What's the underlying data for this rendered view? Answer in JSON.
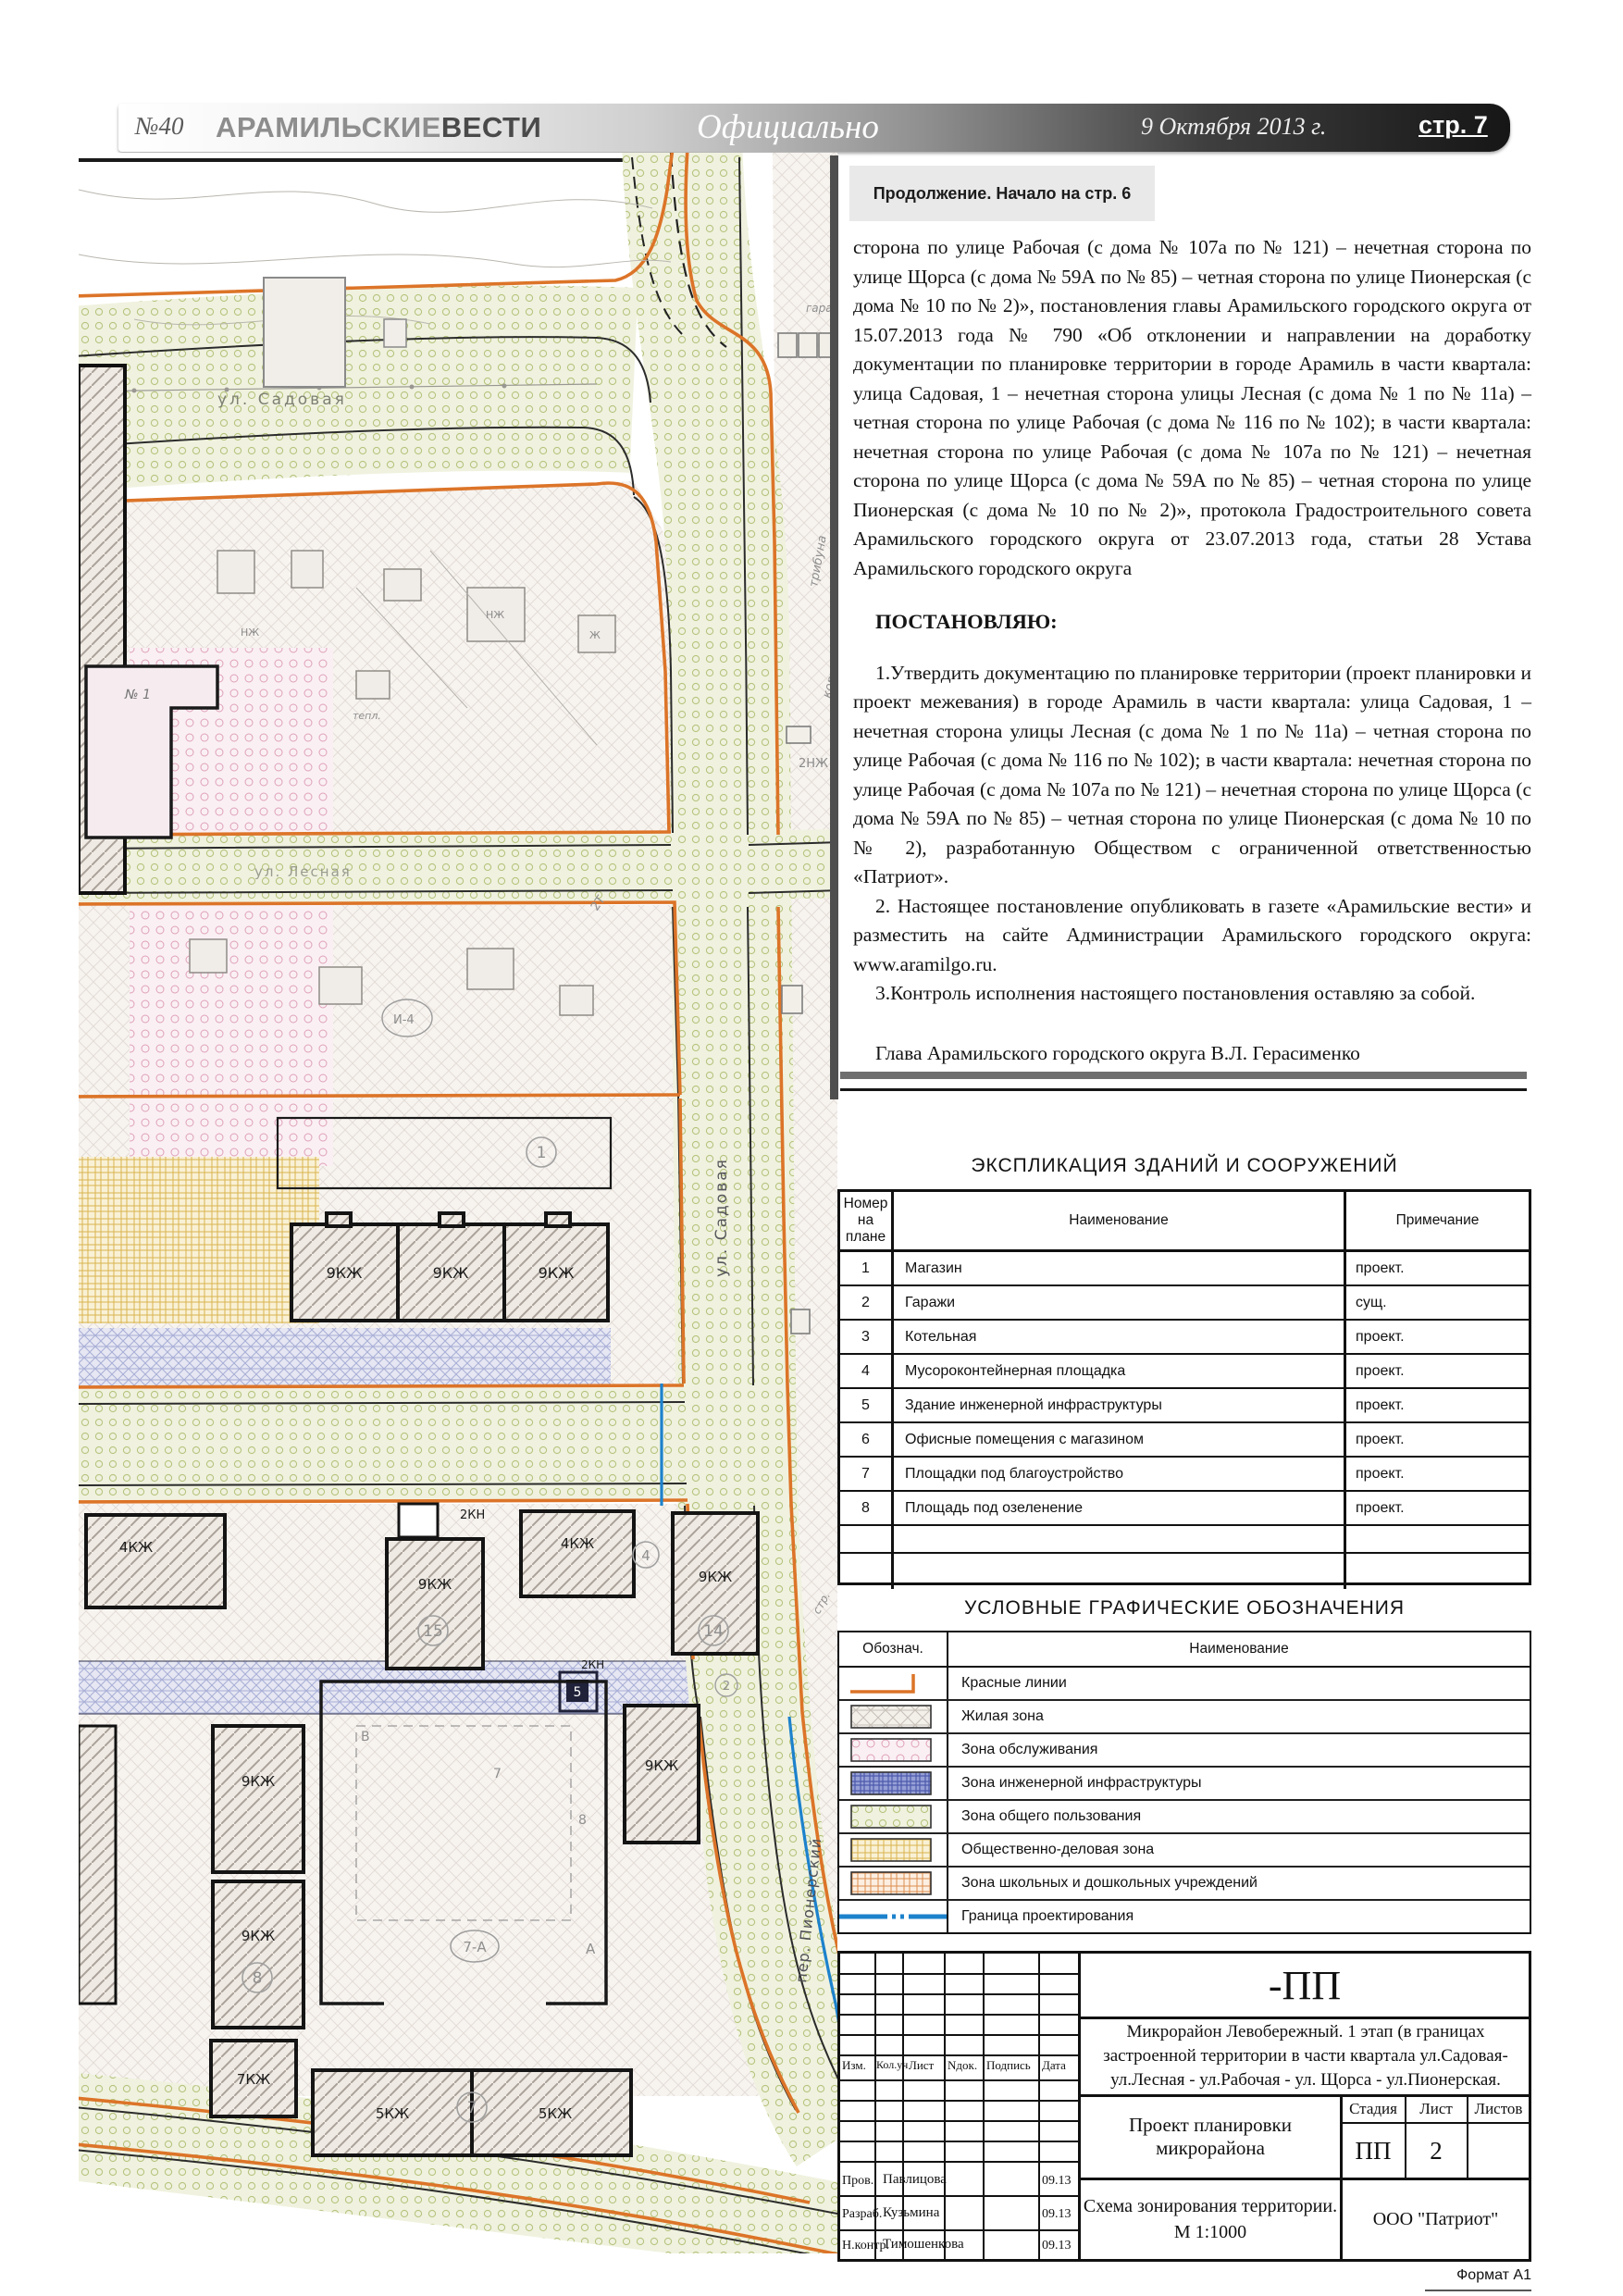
{
  "header": {
    "issue": "№40",
    "brand_light": "АРАМИЛЬСКИЕ",
    "brand_bold": "ВЕСТИ",
    "section": "Официально",
    "date": "9 Октября 2013 г.",
    "page": "стр. 7"
  },
  "continuation_notice": "Продолжение. Начало на стр. 6",
  "article": {
    "paragraphs": [
      "сторона по улице Рабочая (с дома № 107а по № 121) – нечетная сторона по улице Щорса (с дома № 59А по № 85) – четная сторона по улице Пионерская (с дома № 10 по № 2)», постановления главы Арамильского городского округа от 15.07.2013 года № 790 «Об отклонении и направлении на доработку документации по планировке территории в городе Арамиль в части квартала: улица Садовая, 1 – нечетная сторона улицы Лесная (с дома № 1 по № 11а) – четная сторона по улице Рабочая (с дома № 116 по № 102); в части квартала: нечетная сторона по улице Рабочая (с дома № 107а по № 121) – нечетная сторона по улице Щорса (с дома № 59А по № 85) – четная сторона по улице Пионерская (с дома № 10 по № 2)», протокола Градостроительного совета Арамильского городского округа от 23.07.2013 года, статьи 28 Устава Арамильского городского округа"
    ],
    "resolve_heading": "ПОСТАНОВЛЯЮ:",
    "items": [
      "1.Утвердить документацию по планировке территории (проект планировки и проект межевания) в городе Арамиль в части квартала: улица Садовая, 1 – нечетная сторона улицы Лесная (с дома № 1 по № 11а) – четная сторона по улице Рабочая (с дома № 116 по № 102); в части квартала: нечетная сторона по улице Рабочая (с дома № 107а по № 121) – нечетная сторона по улице Щорса (с дома № 59А по № 85) – четная сторона по улице Пионерская (с дома № 10 по № 2), разработанную Обществом с ограниченной ответственностью «Патриот».",
      "2. Настоящее постановление опубликовать в газете «Арамильские вести» и разместить на сайте Администрации Арамильского городского округа: www.aramilgo.ru.",
      "3.Контроль исполнения настоящего постановления оставляю за собой."
    ],
    "signature": "Глава Арамильского городского округа В.Л. Герасименко"
  },
  "explication": {
    "title": "ЭКСПЛИКАЦИЯ ЗДАНИЙ И СООРУЖЕНИЙ",
    "columns": [
      "Номер на плане",
      "Наименование",
      "Примечание"
    ],
    "rows": [
      [
        "1",
        "Магазин",
        "проект."
      ],
      [
        "2",
        "Гаражи",
        "сущ."
      ],
      [
        "3",
        "Котельная",
        "проект."
      ],
      [
        "4",
        "Мусороконтейнерная площадка",
        "проект."
      ],
      [
        "5",
        "Здание инженерной инфраструктуры",
        "проект."
      ],
      [
        "6",
        "Офисные помещения с магазином",
        "проект."
      ],
      [
        "7",
        "Площадки под благоустройство",
        "проект."
      ],
      [
        "8",
        "Площадь под озеленение",
        "проект."
      ]
    ]
  },
  "legend": {
    "title": "УСЛОВНЫЕ ГРАФИЧЕСКИЕ ОБОЗНАЧЕНИЯ",
    "columns": [
      "Обознач.",
      "Наименование"
    ],
    "rows": [
      {
        "symbol": "red-lines",
        "label": "Красные линии"
      },
      {
        "symbol": "residential",
        "label": "Жилая зона"
      },
      {
        "symbol": "service",
        "label": "Зона обслуживания"
      },
      {
        "symbol": "engineering",
        "label": "Зона инженерной инфраструктуры"
      },
      {
        "symbol": "public",
        "label": "Зона общего пользования"
      },
      {
        "symbol": "business",
        "label": "Общественно-деловая зона"
      },
      {
        "symbol": "school",
        "label": "Зона школьных и дошкольных учреждений"
      },
      {
        "symbol": "boundary",
        "label": "Граница проектирования"
      }
    ]
  },
  "title_block": {
    "code": "-ПП",
    "object": "Микрорайон Левобережный. 1 этап (в границах застроенной территории в части квартала ул.Садовая- ул.Лесная - ул.Рабочая - ул. Щорса - ул.Пионерская.",
    "project": "Проект планировки микрорайона",
    "stage_label": "Стадия",
    "sheet_label": "Лист",
    "sheets_label": "Листов",
    "stage": "ПП",
    "sheet": "2",
    "sheets": "",
    "drawing": "Схема зонирования территории.",
    "scale": "М 1:1000",
    "company": "ООО \"Патриот\"",
    "header_cols": [
      "Изм.",
      "Кол.уч",
      "Лист",
      "Nдок.",
      "Подпись",
      "Дата"
    ],
    "signatures": [
      {
        "role": "Пров.",
        "name": "Павлицова",
        "date": "09.13"
      },
      {
        "role": "Разраб.",
        "name": "Кузьмина",
        "date": "09.13"
      },
      {
        "role": "Н.контр.",
        "name": "Тимошенкова",
        "date": "09.13"
      }
    ],
    "format": "Формат А1"
  },
  "map": {
    "street_labels": [
      "ул. Садовая",
      "ул. Садовая",
      "ул. Лесная",
      "пер. Пионерский"
    ],
    "building_labels": [
      "9КЖ",
      "9КЖ",
      "9КЖ",
      "4КЖ",
      "2КН",
      "9КЖ",
      "4КЖ",
      "9КЖ",
      "2КН",
      "9КЖ",
      "9КЖ",
      "9КЖ",
      "7КЖ",
      "5КЖ",
      "5КЖ"
    ],
    "circled_numbers": [
      "1",
      "15",
      "4",
      "14",
      "8",
      "7",
      "2"
    ],
    "misc_labels": [
      "№ 1",
      "трибуна",
      "корт",
      "2НЖ",
      "гараж",
      "7-А",
      "А",
      "В",
      "7",
      "8",
      "2Т",
      "И-4",
      "тепл.",
      "стр.",
      "5"
    ]
  },
  "colors": {
    "red_line": "#dc7428",
    "boundary_blue": "#1d82cc",
    "header_dark": "#1c1c1c",
    "note_bg": "#e9e9e9"
  }
}
